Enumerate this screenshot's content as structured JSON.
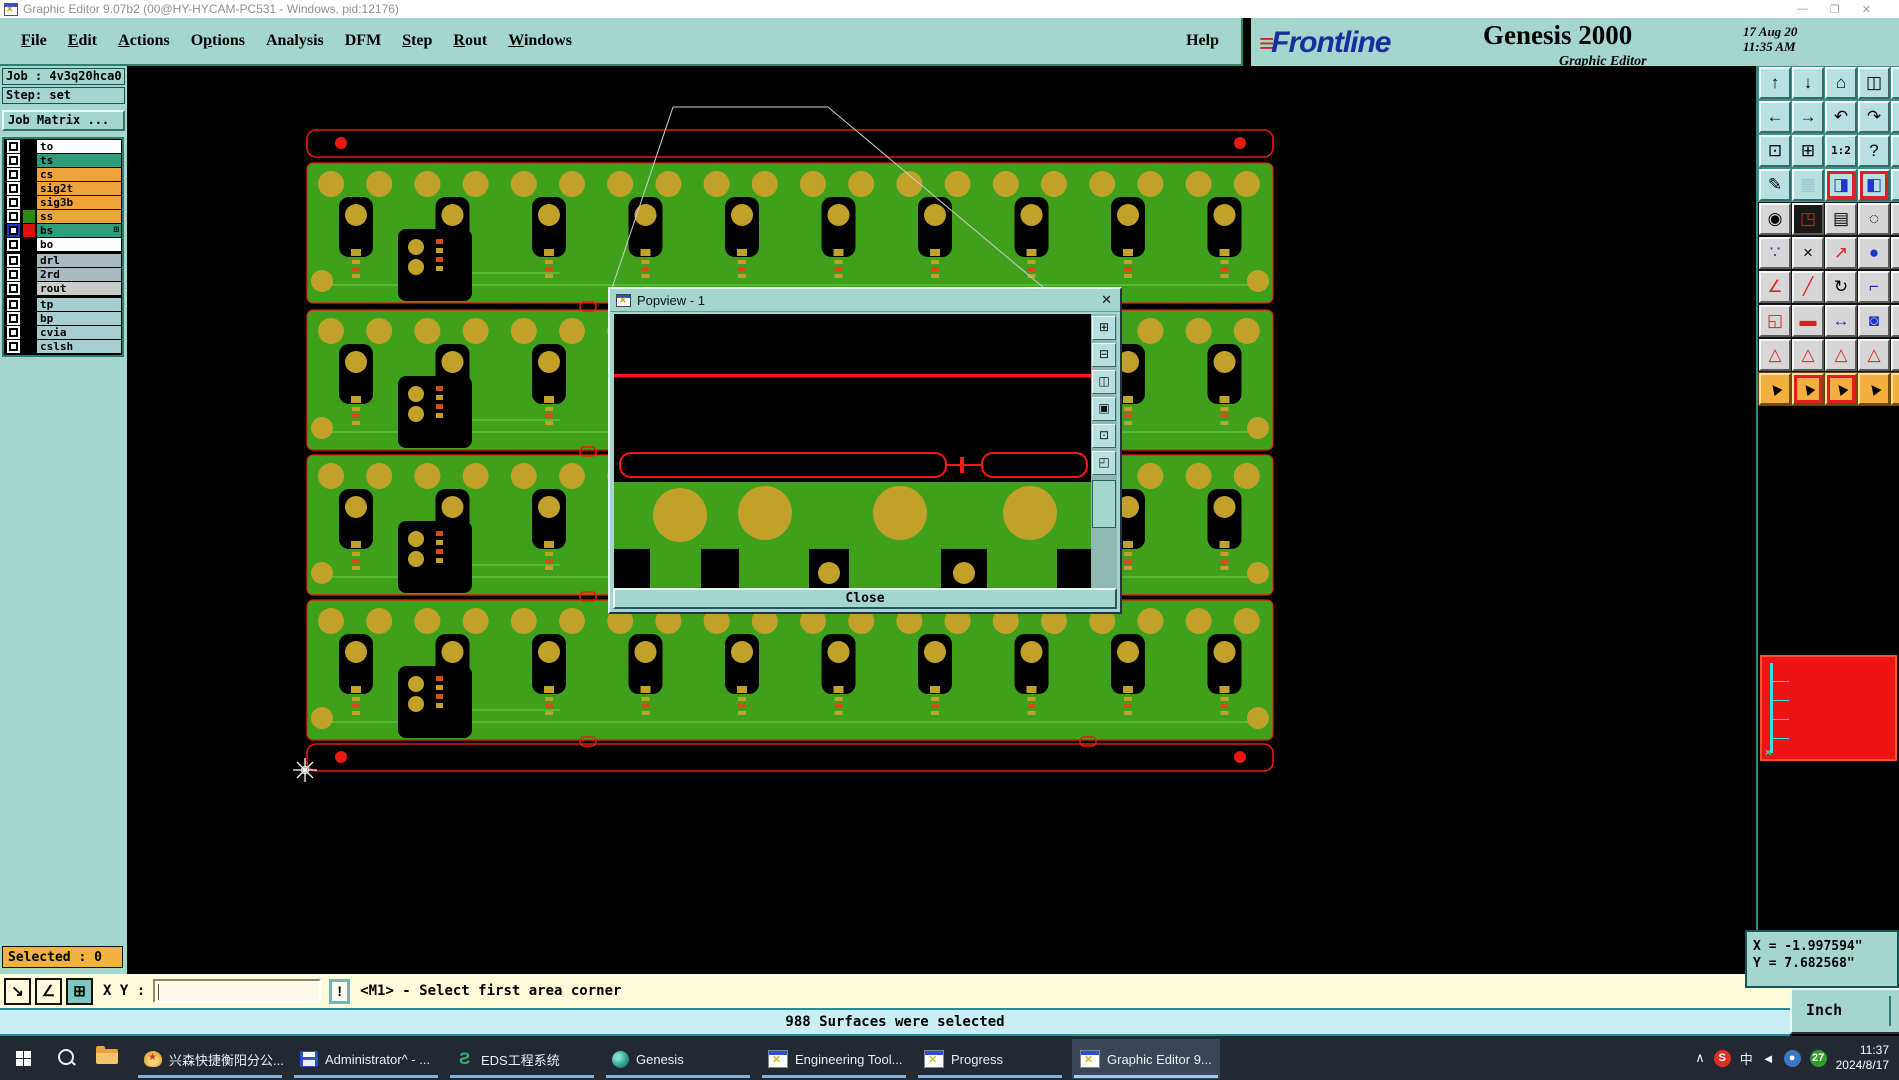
{
  "window": {
    "title": "Graphic Editor 9.07b2 (00@HY-HYCAM-PC531 - Windows, pid:12176)",
    "controls": {
      "minimize": "—",
      "maximize": "❐",
      "close": "✕"
    }
  },
  "menubar": {
    "items": [
      {
        "label": "File",
        "u": 0
      },
      {
        "label": "Edit",
        "u": 0
      },
      {
        "label": "Actions",
        "u": 0
      },
      {
        "label": "Options",
        "u": 1
      },
      {
        "label": "Analysis",
        "u": -1
      },
      {
        "label": "DFM",
        "u": -1
      },
      {
        "label": "Step",
        "u": 0
      },
      {
        "label": "Rout",
        "u": 0
      },
      {
        "label": "Windows",
        "u": 0
      }
    ],
    "help": "Help"
  },
  "brand": {
    "logo": "Frontline",
    "product": "Genesis 2000",
    "date": "17 Aug 20",
    "time": "11:35 AM",
    "subtitle": "Graphic Editor"
  },
  "job_panel": {
    "job_label": "Job : 4v3q20hca0",
    "step_label": "Step: set",
    "matrix_button": "Job Matrix ..."
  },
  "layer_list": {
    "groups": [
      {
        "layers": [
          {
            "name": "to",
            "bg": "#ffffff",
            "swatch": "#000000",
            "selected": false
          },
          {
            "name": "ts",
            "bg": "#2f9e7d",
            "swatch": "#000000",
            "selected": false
          },
          {
            "name": "cs",
            "bg": "#efa33b",
            "swatch": "#000000",
            "selected": false
          },
          {
            "name": "sig2t",
            "bg": "#efa33b",
            "swatch": "#000000",
            "selected": false
          },
          {
            "name": "sig3b",
            "bg": "#efa33b",
            "swatch": "#000000",
            "selected": false
          },
          {
            "name": "ss",
            "bg": "#efa33b",
            "swatch": "#2f8a10",
            "selected": false
          },
          {
            "name": "bs",
            "bg": "#2f9e7d",
            "swatch": "#e01010",
            "selected": true
          },
          {
            "name": "bo",
            "bg": "#ffffff",
            "swatch": "#000000",
            "selected": false
          }
        ]
      },
      {
        "layers": [
          {
            "name": "drl",
            "bg": "#a9bac1",
            "swatch": "#000000",
            "selected": false
          },
          {
            "name": "2rd",
            "bg": "#a9bac1",
            "swatch": "#000000",
            "selected": false
          },
          {
            "name": "rout",
            "bg": "#c9cdc9",
            "swatch": "#000000",
            "selected": false
          }
        ]
      },
      {
        "layers": [
          {
            "name": "tp",
            "bg": "#a6ced0",
            "swatch": "#000000",
            "selected": false
          },
          {
            "name": "bp",
            "bg": "#a6ced0",
            "swatch": "#000000",
            "selected": false
          },
          {
            "name": "cvia",
            "bg": "#a6ced0",
            "swatch": "#000000",
            "selected": false
          },
          {
            "name": "cslsh",
            "bg": "#a6ced0",
            "swatch": "#000000",
            "selected": false
          }
        ]
      }
    ]
  },
  "popview": {
    "title": "Popview - 1",
    "close_x": "✕",
    "close_button": "Close",
    "side_icons": [
      {
        "name": "pop-zoom-in-icon",
        "glyph": "⊞"
      },
      {
        "name": "pop-zoom-out-icon",
        "glyph": "⊟"
      },
      {
        "name": "pop-detach-view-icon",
        "glyph": "◫"
      },
      {
        "name": "pop-overlay-view-icon",
        "glyph": "▣"
      },
      {
        "name": "pop-pan-view-icon",
        "glyph": "⊡"
      },
      {
        "name": "pop-sync-view-icon",
        "glyph": "◰"
      }
    ]
  },
  "toolbar": {
    "rows": [
      {
        "btn": "cyan",
        "gapbg": "#3d9288",
        "items": [
          {
            "name": "pan-up-icon",
            "glyph": "↑"
          },
          {
            "name": "pan-down-icon",
            "glyph": "↓"
          },
          {
            "name": "home-view-icon",
            "glyph": "⌂"
          },
          {
            "name": "split-window-icon",
            "glyph": "◫"
          },
          {
            "name": "tile-window-icon",
            "glyph": "▣"
          }
        ]
      },
      {
        "btn": "cyan",
        "gapbg": "#3d9288",
        "items": [
          {
            "name": "pan-left-icon",
            "glyph": "←"
          },
          {
            "name": "pan-right-icon",
            "glyph": "→"
          },
          {
            "name": "previous-view-icon",
            "glyph": "↶"
          },
          {
            "name": "next-view-icon",
            "glyph": "↷"
          },
          {
            "name": "refresh-view-icon",
            "glyph": "↻"
          }
        ]
      },
      {
        "btn": "cyan",
        "gapbg": "#3d9288",
        "items": [
          {
            "name": "zoom-fit-icon",
            "glyph": "⊡"
          },
          {
            "name": "zoom-center-icon",
            "glyph": "⊞"
          },
          {
            "name": "zoom-ratio-icon",
            "glyph": "1:2",
            "small": true
          },
          {
            "name": "help-pointer-icon",
            "glyph": "?"
          },
          {
            "name": "info-icon",
            "glyph": "i"
          }
        ]
      },
      {
        "btn": "cyan",
        "gapbg": "#3d9288",
        "items": [
          {
            "name": "setup-tools-icon",
            "glyph": "✎"
          },
          {
            "name": "grid-toggle-icon",
            "glyph": "▦",
            "color": "#9bc7d4"
          },
          {
            "name": "netlist-view-icon",
            "glyph": "◨",
            "color": "#2233cc",
            "frame": true
          },
          {
            "name": "net-compare-icon",
            "glyph": "◧",
            "color": "#2233cc",
            "frame": true
          },
          {
            "name": "net-extra-icon",
            "glyph": "●",
            "color": "#2233cc"
          }
        ]
      },
      {
        "btn": "gray",
        "gapbg": "#141414",
        "items": [
          {
            "name": "move-feature-icon",
            "glyph": "◉"
          },
          {
            "name": "transform-feature-icon",
            "glyph": "◳",
            "dark": true
          },
          {
            "name": "measure-ruler-icon",
            "glyph": "▤"
          },
          {
            "name": "select-area-icon",
            "glyph": "◌"
          },
          {
            "name": "select-dot-icon",
            "glyph": "●"
          }
        ]
      },
      {
        "btn": "gray",
        "gapbg": "#141414",
        "items": [
          {
            "name": "chain-select-icon",
            "glyph": "∵",
            "color": "#2233cc"
          },
          {
            "name": "delete-feature-icon",
            "glyph": "×"
          },
          {
            "name": "copy-feature-icon",
            "glyph": "↗",
            "color": "#e02020"
          },
          {
            "name": "move-origin-icon",
            "glyph": "●",
            "color": "#2233cc"
          },
          {
            "name": "snap-dot-icon",
            "glyph": "●",
            "color": "#2233cc"
          }
        ]
      },
      {
        "btn": "gray",
        "gapbg": "#141414",
        "items": [
          {
            "name": "angle-measure-icon",
            "glyph": "∠",
            "color": "#e02020"
          },
          {
            "name": "line-draw-icon",
            "glyph": "╱",
            "color": "#e02020"
          },
          {
            "name": "rotate-tool-icon",
            "glyph": "↻"
          },
          {
            "name": "mirror-tool-icon",
            "glyph": "⌐",
            "color": "#2233cc"
          },
          {
            "name": "flip-tool-icon",
            "glyph": "⌐",
            "color": "#2233cc"
          }
        ]
      },
      {
        "btn": "gray",
        "gapbg": "#141414",
        "items": [
          {
            "name": "swap-pads-icon",
            "glyph": "◱",
            "color": "#e02020"
          },
          {
            "name": "break-line-icon",
            "glyph": "▬",
            "color": "#e02020"
          },
          {
            "name": "dimension-icon",
            "glyph": "↔",
            "color": "#2233cc"
          },
          {
            "name": "pad-mask-icon",
            "glyph": "◙",
            "color": "#2233cc"
          },
          {
            "name": "pad-extra-icon",
            "glyph": "◙",
            "color": "#2233cc"
          }
        ]
      },
      {
        "btn": "gray",
        "gapbg": "#141414",
        "items": [
          {
            "name": "dfm-triangle-1-icon",
            "glyph": "△",
            "color": "#e02020"
          },
          {
            "name": "dfm-triangle-2-icon",
            "glyph": "△",
            "color": "#e02020"
          },
          {
            "name": "dfm-triangle-3-icon",
            "glyph": "△",
            "color": "#e02020"
          },
          {
            "name": "dfm-triangle-4-icon",
            "glyph": "△",
            "color": "#e02020"
          },
          {
            "name": "dfm-triangle-5-icon",
            "glyph": "△",
            "color": "#e02020"
          }
        ]
      },
      {
        "btn": "orange",
        "gapbg": "#6a4406",
        "items": [
          {
            "name": "select-pointer-icon",
            "glyph": "▲",
            "rot": true
          },
          {
            "name": "select-frame-icon",
            "glyph": "▲",
            "rot": true,
            "frame": true
          },
          {
            "name": "select-polygon-icon",
            "glyph": "▲",
            "rot": true,
            "frame": true
          },
          {
            "name": "select-net-icon",
            "glyph": "▲",
            "rot": true
          },
          {
            "name": "select-extra-icon",
            "glyph": "▲",
            "rot": true
          }
        ]
      }
    ]
  },
  "coords": {
    "x": "X = -1.997594\"",
    "y": "Y = 7.682568\""
  },
  "units": {
    "label": "Inch"
  },
  "bottom": {
    "selected": "Selected : 0",
    "tool_icons": [
      {
        "name": "resize-corner-icon",
        "glyph": "↘",
        "selected": false
      },
      {
        "name": "angle-snap-icon",
        "glyph": "∠",
        "selected": false
      },
      {
        "name": "grid-snap-icon",
        "glyph": "⊞",
        "selected": true
      }
    ],
    "xy_label": "X Y :",
    "xy_value": "",
    "alert_button": "!",
    "prompt": "<M1> - Select first area corner",
    "message": "988 Surfaces were selected"
  },
  "taskbar": {
    "apps": [
      {
        "label": "兴森快捷衡阳分公...",
        "icon": "shell",
        "active": false
      },
      {
        "label": "Administrator^ - ...",
        "icon": "floppy",
        "active": false
      },
      {
        "label": "EDS工程系统",
        "icon": "eds",
        "active": false
      },
      {
        "label": "Genesis",
        "icon": "genesis",
        "active": false
      },
      {
        "label": "Engineering Tool...",
        "icon": "xwin",
        "active": false
      },
      {
        "label": "Progress",
        "icon": "xwin",
        "active": false
      },
      {
        "label": "Graphic Editor 9...",
        "icon": "xwin",
        "active": true
      }
    ],
    "tray": {
      "chevron": "∧",
      "icons": [
        {
          "name": "sogou-icon",
          "text": "S",
          "bg": "#e03020"
        },
        {
          "name": "lang-indicator",
          "text": "中",
          "bg": ""
        },
        {
          "name": "speaker-icon",
          "text": "◄",
          "bg": ""
        },
        {
          "name": "network-icon",
          "text": "●",
          "bg": "#3b77c2"
        },
        {
          "name": "notification-badge",
          "text": "27",
          "bg": "#2f9e30"
        }
      ],
      "time": "11:37",
      "date": "2024/8/17"
    }
  }
}
